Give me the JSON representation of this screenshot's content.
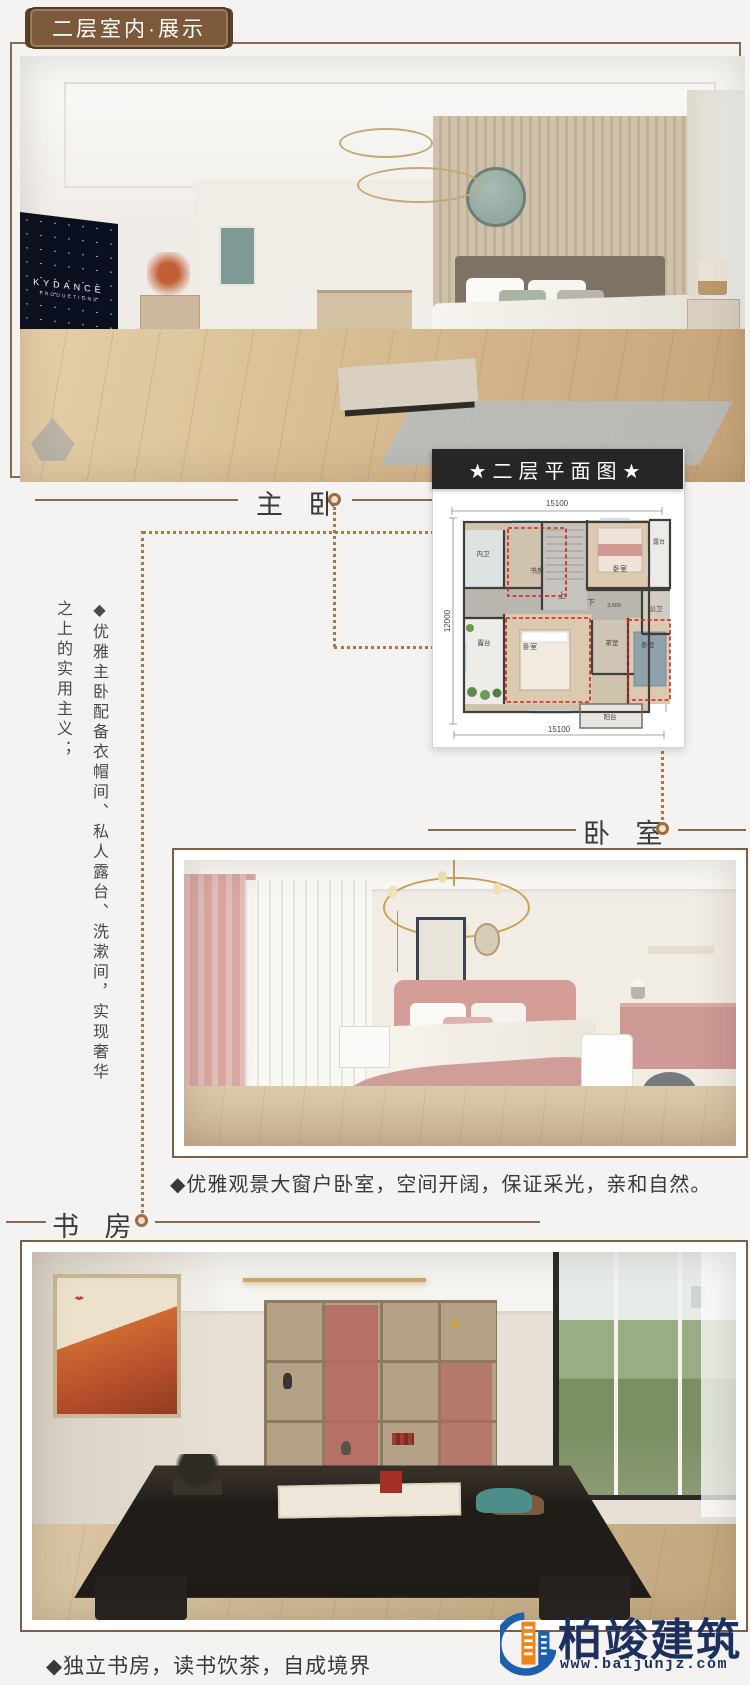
{
  "badge": "二层室内·展示",
  "labels": {
    "master": "主 卧",
    "bedroom": "卧 室",
    "study": "书 房"
  },
  "floorplan": {
    "banner": "★二层平面图★",
    "dim_top": "15100",
    "dim_bottom": "15100",
    "dim_left": "12000",
    "dim_right": "12000",
    "stair_up": "上",
    "stair_down": "下",
    "elevation": "3,600",
    "rooms": {
      "bath_master": "内卫",
      "study": "书房",
      "bedroom_tr": "卧室",
      "terrace_tr": "露台",
      "bath_public": "公卫",
      "tea_room": "茶室",
      "terrace_left": "露台",
      "bedroom_bl": "卧室",
      "bedroom_br": "卧室",
      "balcony": "阳台"
    }
  },
  "note_line1": "◆优雅主卧配备衣帽间、私人露台、洗漱间，实现奢华",
  "note_line2": "之上的实用主义；",
  "captions": {
    "bedroom": "◆优雅观景大窗户卧室，空间开阔，保证采光，亲和自然。",
    "study": "◆独立书房，读书饮茶，自成境界"
  },
  "photo1": {
    "tv_brand": "KYDANCE",
    "tv_sub": "PRODUCTIONS"
  },
  "logo": {
    "name": "柏竣建筑",
    "site": "www.baijunjz.com"
  },
  "colors": {
    "accent_brown": "#7c593a",
    "banner_bg": "#272625",
    "highlight_red": "#d32020",
    "logo_navy": "#1c2f5e",
    "logo_orange": "#f08519"
  }
}
